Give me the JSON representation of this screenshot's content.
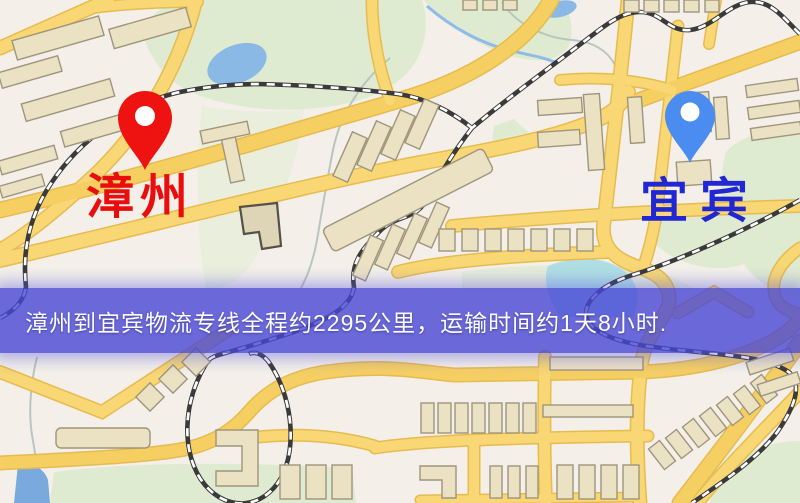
{
  "banner": {
    "text": "漳州到宜宾物流专线全程约2295公里，运输时间约1天8小时.",
    "bg_color": "#4947d5",
    "text_color": "#fdfdff"
  },
  "markers": [
    {
      "id": "origin",
      "label": "漳州",
      "pin_color": "#ee1310",
      "label_color": "#ea0d0d"
    },
    {
      "id": "destination",
      "label": "宜宾",
      "pin_color": "#4a8cf0",
      "label_color": "#2127d2"
    }
  ],
  "map_theme": {
    "background": "#f4f0e9",
    "road_fill": "#f8d774",
    "road_casing": "#e6bb50",
    "railway": "#3a3a3a",
    "green_area": "#dfebd1",
    "water": "#8ab9e6",
    "building_fill": "#ebe2c3",
    "building_stroke": "#9f957d"
  }
}
